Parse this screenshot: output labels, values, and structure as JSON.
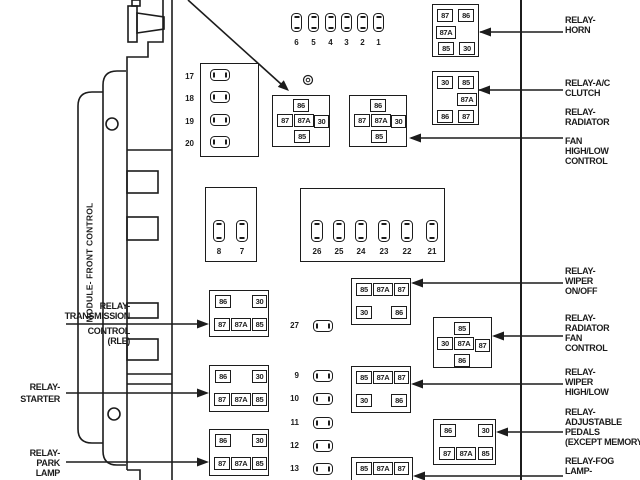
{
  "colors": {
    "ink": "#1c1c1c",
    "background": "#ffffff"
  },
  "module": {
    "label": "MODULE- FRONT CONTROL"
  },
  "fuses": {
    "top": [
      "6",
      "5",
      "4",
      "3",
      "2",
      "1"
    ],
    "left_column": [
      "17",
      "18",
      "19",
      "20"
    ],
    "pair": [
      "8",
      "7"
    ],
    "mid_row": [
      "26",
      "25",
      "24",
      "23",
      "22",
      "21"
    ],
    "single": [
      "27"
    ],
    "bottom_column": [
      "9",
      "10",
      "11",
      "12",
      "13"
    ]
  },
  "relays": {
    "box_a": {
      "pins": [
        "86",
        "87",
        "87A",
        "30",
        "85"
      ]
    },
    "box_b": {
      "pins": [
        "86",
        "87",
        "87A",
        "30",
        "85"
      ]
    },
    "horn": {
      "pins": [
        "87",
        "86",
        "87A",
        "85",
        "30"
      ]
    },
    "ac_clutch": {
      "pins": [
        "30",
        "85",
        "87A",
        "86",
        "87"
      ]
    },
    "transmission": {
      "pins": [
        "86",
        "30",
        "87",
        "87A",
        "85"
      ]
    },
    "starter": {
      "pins": [
        "86",
        "30",
        "87",
        "87A",
        "85"
      ]
    },
    "park_lamp": {
      "pins": [
        "86",
        "30",
        "87",
        "87A",
        "85"
      ]
    },
    "adjustable_pedals": {
      "pins": [
        "86",
        "30",
        "87",
        "87A",
        "85"
      ]
    },
    "wiper_on_off": {
      "pins": [
        "85",
        "87A",
        "87",
        "30",
        "86"
      ]
    },
    "wiper_high_low": {
      "pins": [
        "85",
        "87A",
        "87",
        "30",
        "86"
      ]
    },
    "fog_lamp": {
      "pins": [
        "85",
        "87A",
        "87"
      ]
    },
    "rad_fan_control": {
      "pins": [
        "85",
        "30",
        "87A",
        "87",
        "86"
      ]
    }
  },
  "labels": {
    "left": {
      "transmission": [
        "RELAY-",
        "TRANSMISSION",
        "CONTROL",
        "(RLE)"
      ],
      "starter": [
        "RELAY-",
        "STARTER"
      ],
      "park_lamp": [
        "RELAY-",
        "PARK",
        "LAMP"
      ]
    },
    "right": {
      "horn": [
        "RELAY-",
        "HORN"
      ],
      "ac_clutch": [
        "RELAY-A/C",
        "CLUTCH"
      ],
      "rad_fan_high_low": [
        "RELAY-",
        "RADIATOR",
        "FAN",
        "HIGH/LOW",
        "CONTROL"
      ],
      "wiper_on_off": [
        "RELAY-",
        "WIPER",
        "ON/OFF"
      ],
      "rad_fan_control": [
        "RELAY-",
        "RADIATOR",
        "FAN",
        "CONTROL"
      ],
      "wiper_high_low": [
        "RELAY-",
        "WIPER",
        "HIGH/LOW"
      ],
      "adjustable_pedals": [
        "RELAY-",
        "ADJUSTABLE",
        "PEDALS",
        "(EXCEPT MEMORY)"
      ],
      "fog_lamp": [
        "RELAY-FOG",
        "LAMP-"
      ]
    }
  }
}
